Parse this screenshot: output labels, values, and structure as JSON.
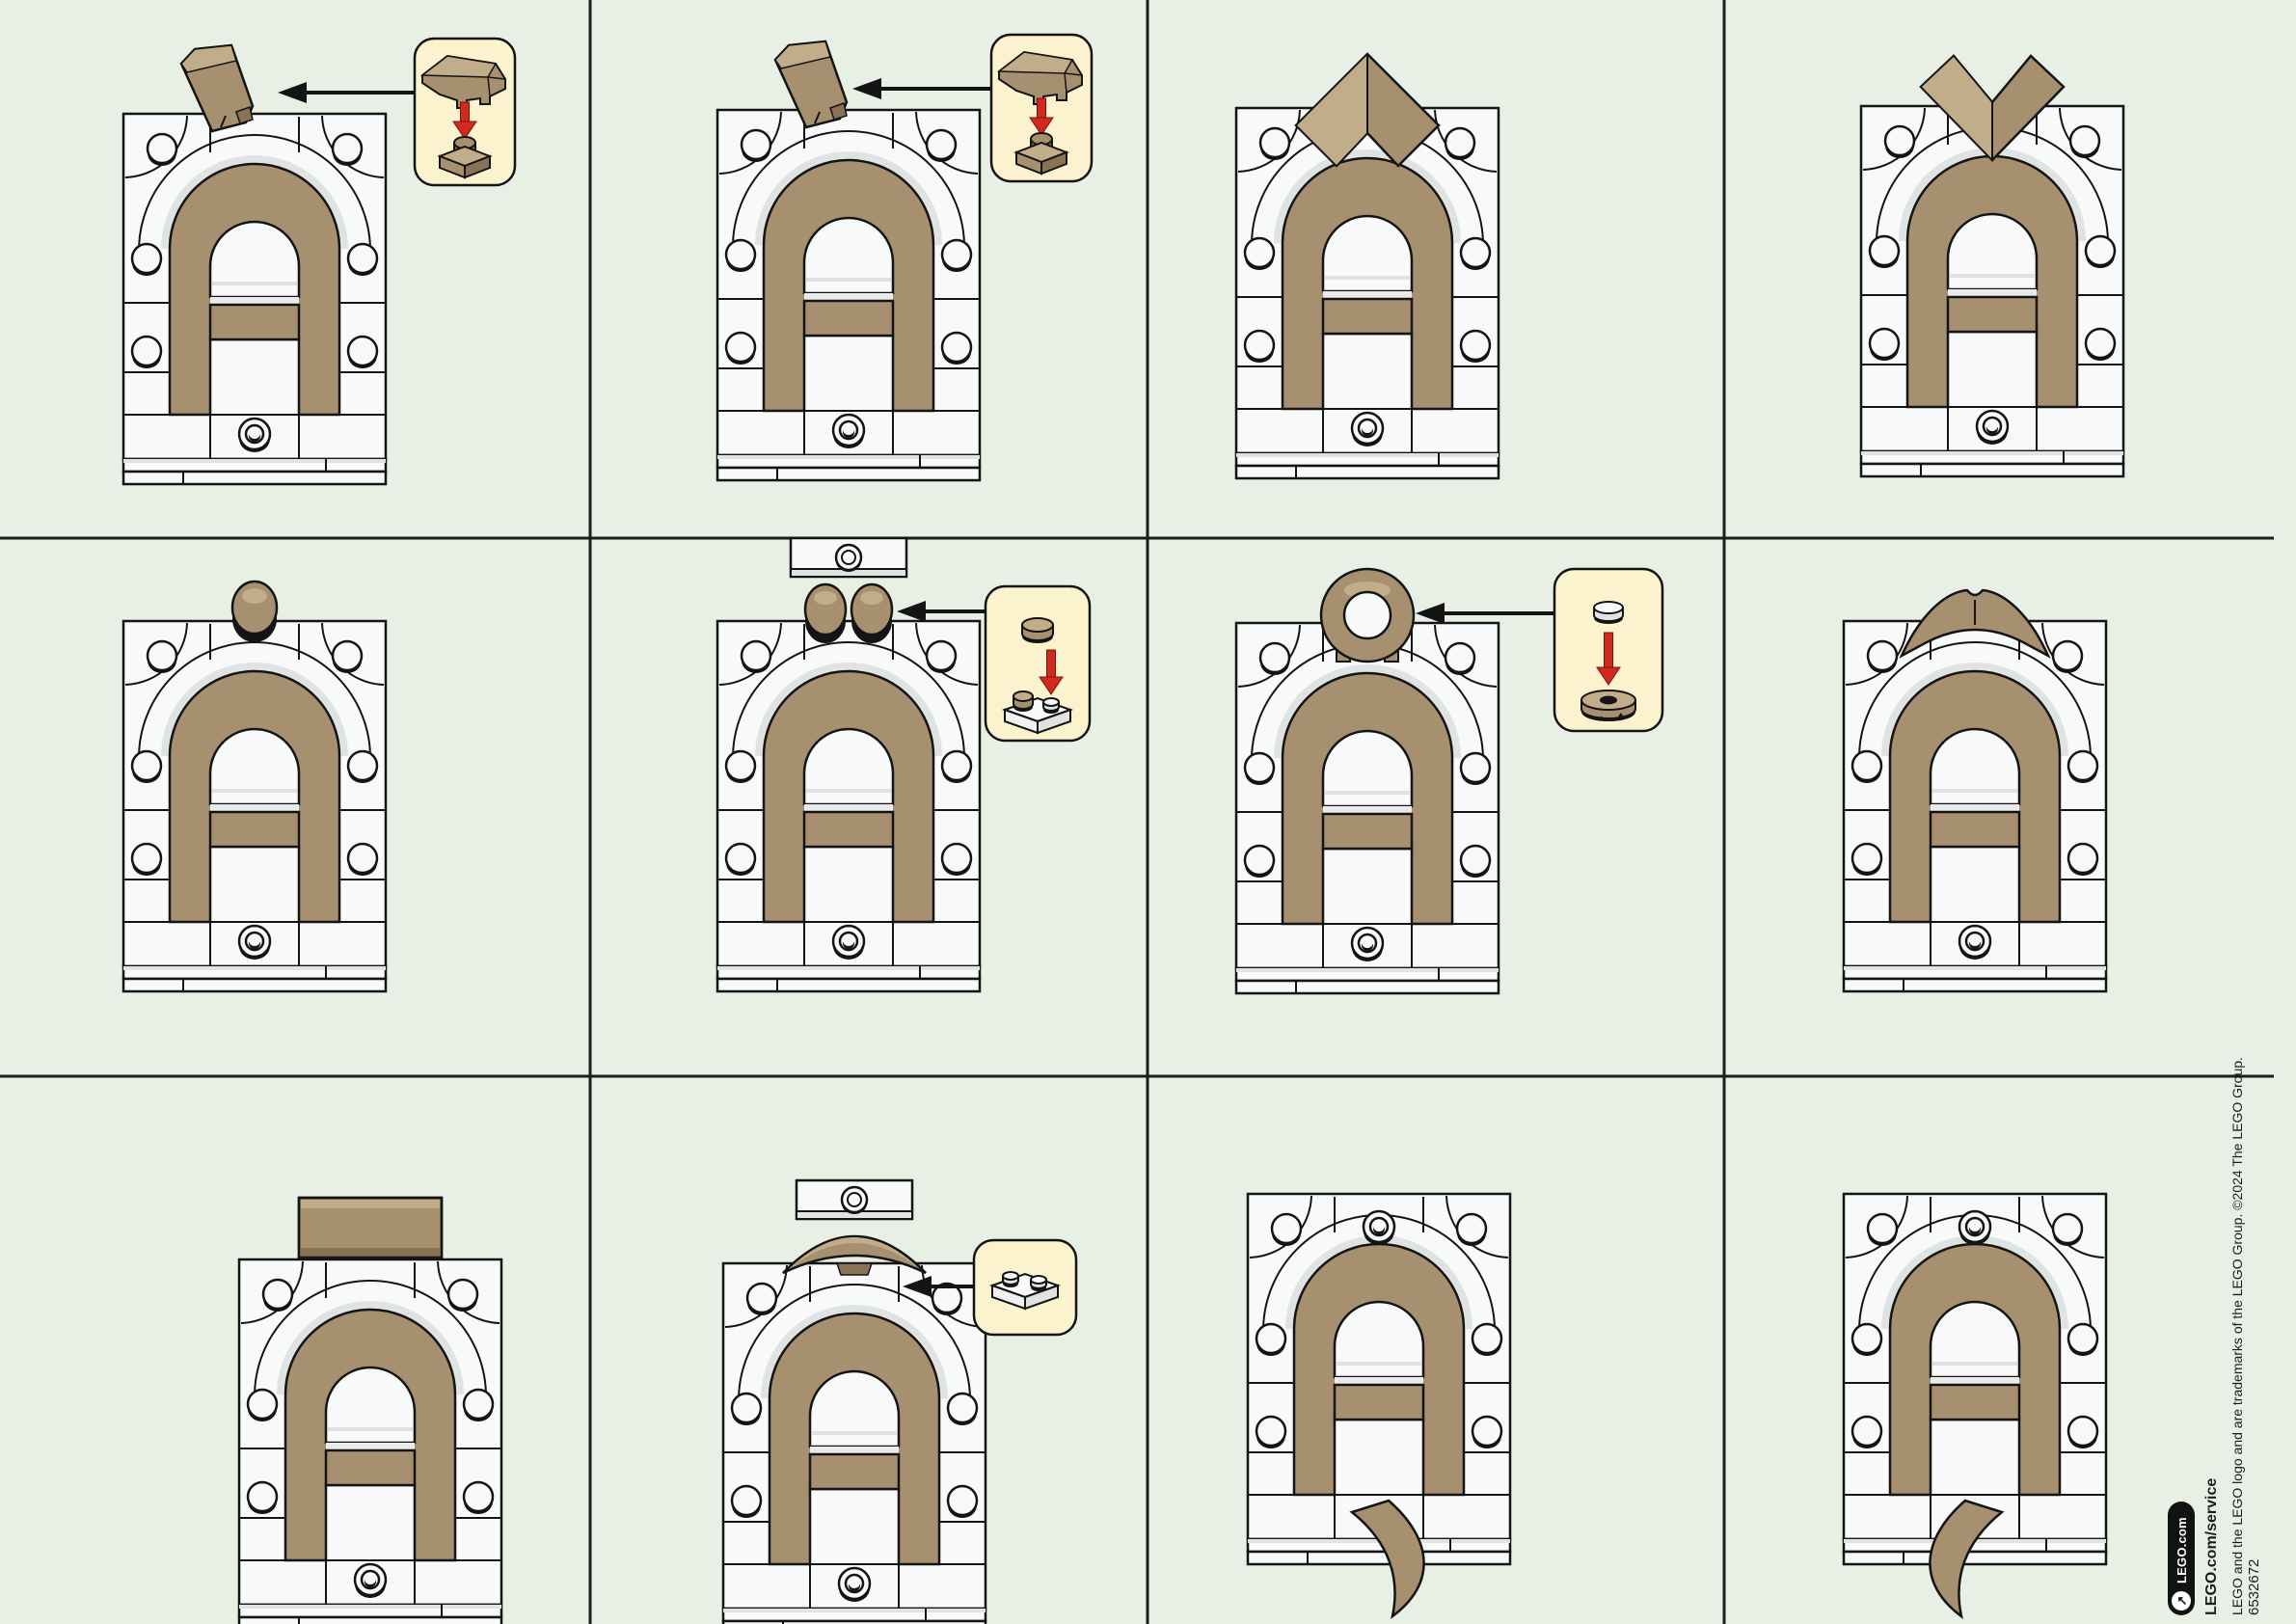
{
  "colors": {
    "background": "#e8f0e5",
    "grid_line": "#1d1d1d",
    "brick_white": "#f7faf9",
    "brick_white_shade": "#dfe3e1",
    "tan": "#a6906f",
    "tan_light": "#c2ad8b",
    "tan_dark": "#8a7257",
    "outline": "#141414",
    "callout_bg": "#fbf3cd",
    "red_arrow": "#d02a1f"
  },
  "grid": {
    "rows": 3,
    "cols": 4
  },
  "cells": [
    {
      "id": "r1c1",
      "row": 1,
      "col": 1,
      "model": "arch-letter-a",
      "ring_position": "bottom",
      "addon": "tan-wedge-slope",
      "callout": {
        "pieces": [
          "tan-wedge-slope",
          "tan-plate-1x1"
        ],
        "red_arrow": true
      },
      "connector_arrow": true
    },
    {
      "id": "r1c2",
      "row": 1,
      "col": 2,
      "model": "arch-letter-a",
      "ring_position": "bottom",
      "addon": "tan-wedge-slope",
      "callout": {
        "pieces": [
          "tan-wedge-slope",
          "tan-plate-1x1"
        ],
        "red_arrow": true
      },
      "connector_arrow": true
    },
    {
      "id": "r1c3",
      "row": 1,
      "col": 3,
      "model": "arch-letter-a",
      "ring_position": "bottom",
      "addon": "tan-diamond-peak",
      "callout": null,
      "connector_arrow": false
    },
    {
      "id": "r1c4",
      "row": 1,
      "col": 4,
      "model": "arch-letter-a",
      "ring_position": "bottom",
      "addon": "tan-chevron-v",
      "callout": null,
      "connector_arrow": false
    },
    {
      "id": "r2c1",
      "row": 2,
      "col": 1,
      "model": "arch-letter-a",
      "ring_position": "bottom",
      "addon": "tan-round-stud",
      "callout": null,
      "connector_arrow": false
    },
    {
      "id": "r2c2",
      "row": 2,
      "col": 2,
      "model": "arch-letter-a",
      "ring_position": "bottom",
      "addon": "two-tan-round-studs",
      "floating_piece": "white-plate-1x2",
      "callout": {
        "pieces": [
          "tan-round-plate-1x1",
          "white-plate-1x2-with-tan-stud"
        ],
        "red_arrow": true
      },
      "connector_arrow": true
    },
    {
      "id": "r2c3",
      "row": 2,
      "col": 3,
      "model": "arch-letter-a",
      "ring_position": "bottom",
      "addon": "tan-ring-plate",
      "callout": {
        "pieces": [
          "white-round-tile-1x1",
          "tan-round-plate-2x2"
        ],
        "red_arrow": true
      },
      "connector_arrow": true
    },
    {
      "id": "r2c4",
      "row": 2,
      "col": 4,
      "model": "arch-letter-a",
      "ring_position": "bottom",
      "addon": "tan-curved-wing",
      "callout": null,
      "connector_arrow": false
    },
    {
      "id": "r3c1",
      "row": 3,
      "col": 1,
      "model": "arch-letter-a",
      "ring_position": "bottom",
      "addon": "tan-brick-2x3",
      "callout": null,
      "connector_arrow": false
    },
    {
      "id": "r3c2",
      "row": 3,
      "col": 2,
      "model": "arch-letter-a",
      "ring_position": "bottom",
      "addon": "tan-curved-bow",
      "floating_piece": "white-plate-1x2",
      "callout": {
        "pieces": [
          "white-plate-1x2"
        ],
        "red_arrow": false
      },
      "connector_arrow": true
    },
    {
      "id": "r3c3",
      "row": 3,
      "col": 3,
      "model": "arch-letter-a",
      "ring_position": "top",
      "addon": "tan-curved-tail-right",
      "callout": null,
      "connector_arrow": false
    },
    {
      "id": "r3c4",
      "row": 3,
      "col": 4,
      "model": "arch-letter-a",
      "ring_position": "top",
      "addon": "tan-curved-tail-left",
      "callout": null,
      "connector_arrow": false
    }
  ],
  "footer": {
    "pill_label": "LEGO.com",
    "pill_icon": "arrow-up-right-icon",
    "service_text": "LEGO.com/service",
    "legal_text": "LEGO and the LEGO logo and are trademarks of the LEGO Group. ©2024 The LEGO Group.",
    "item_number": "6532672"
  }
}
